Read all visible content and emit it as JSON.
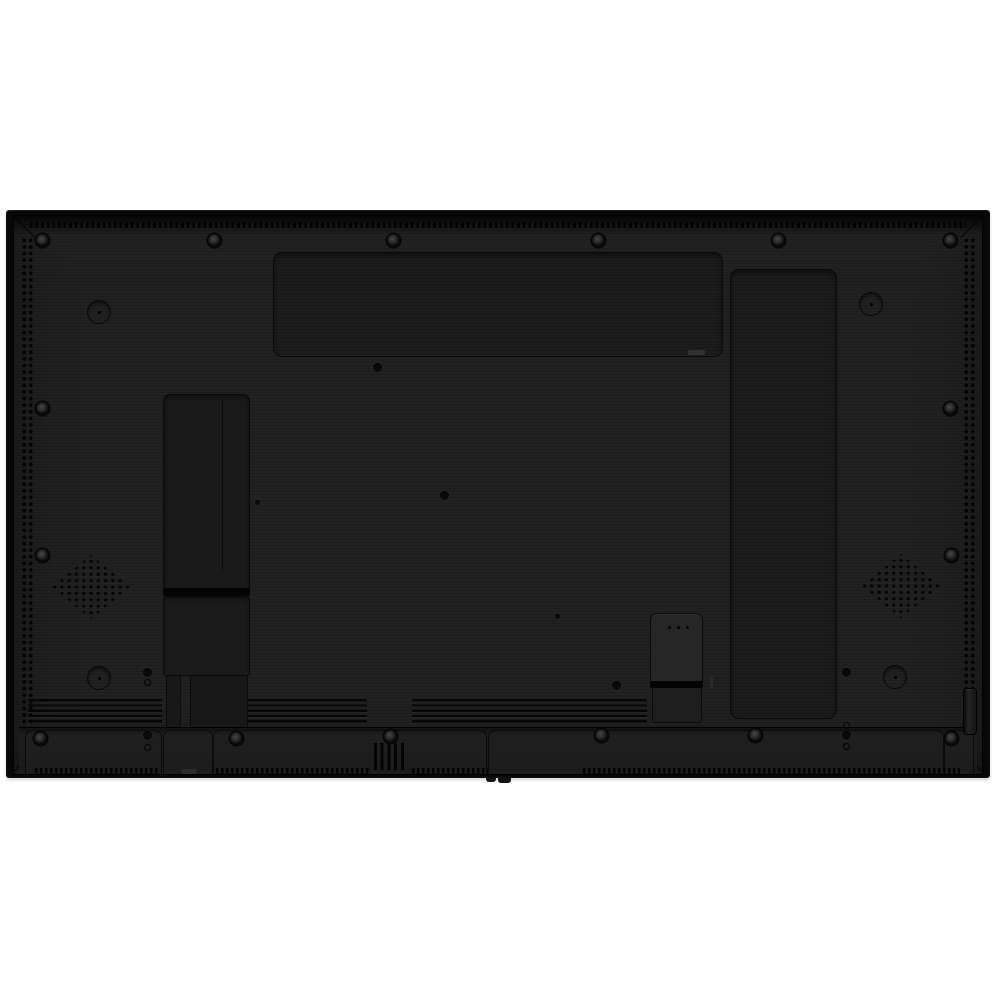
{
  "subject": "rear-of-flat-panel-display",
  "scene": {
    "width": 1000,
    "height": 1000
  },
  "colors": {
    "bg": "#ffffff",
    "shell": "#070707",
    "cover": "#1d1d1d",
    "recess": "#1a1a1a",
    "groove": "#040404",
    "screw-ring": "#474747",
    "vent-dot": "#030303"
  },
  "elements": [
    {
      "name": "tv-outer-shell",
      "cls": "tv-frame",
      "rect": [
        6,
        210,
        984,
        568
      ]
    },
    {
      "name": "tv-back-cover",
      "cls": "tv-back",
      "rect": [
        13,
        215,
        970,
        560
      ]
    },
    {
      "name": "top-edge-shade",
      "cls": "top-shade",
      "rect": [
        13,
        215,
        970,
        20
      ]
    },
    {
      "name": "top-vent-strip",
      "cls": "perf-top",
      "rect": [
        30,
        222,
        936,
        6
      ]
    },
    {
      "name": "left-edge-vent",
      "cls": "vent-col",
      "rect": [
        20,
        236,
        13,
        528
      ]
    },
    {
      "name": "right-edge-vent",
      "cls": "vent-col",
      "rect": [
        962,
        236,
        13,
        528
      ]
    },
    {
      "name": "chamfer-top-left",
      "cls": "chamfer",
      "rect": [
        10,
        227,
        30,
        1
      ],
      "style": {
        "transform": "rotate(45deg)"
      }
    },
    {
      "name": "chamfer-top-right",
      "cls": "chamfer",
      "rect": [
        956,
        227,
        30,
        1
      ],
      "style": {
        "transform": "rotate(-45deg)"
      }
    },
    {
      "name": "chamfer-bottom-left",
      "cls": "chamfer",
      "rect": [
        10,
        760,
        30,
        1
      ],
      "style": {
        "transform": "rotate(-45deg)"
      }
    },
    {
      "name": "chamfer-bottom-right",
      "cls": "chamfer",
      "rect": [
        956,
        760,
        30,
        1
      ],
      "style": {
        "transform": "rotate(45deg)"
      }
    },
    {
      "name": "top-module-bay",
      "cls": "bay",
      "rect": [
        273,
        252,
        450,
        105
      ]
    },
    {
      "name": "module-bay-slot",
      "cls": "slot",
      "rect": [
        688,
        350,
        17,
        5
      ]
    },
    {
      "name": "right-module-bay",
      "cls": "bay",
      "rect": [
        730,
        269,
        107,
        450
      ]
    },
    {
      "name": "cable-channel-upper",
      "cls": "channel",
      "rect": [
        163,
        394,
        87,
        196
      ]
    },
    {
      "name": "channel-inner-line",
      "cls": "hairline-v",
      "rect": [
        222,
        400,
        1,
        170
      ]
    },
    {
      "name": "channel-groove",
      "cls": "groove",
      "rect": [
        163,
        588,
        87,
        8
      ]
    },
    {
      "name": "cable-channel-lower",
      "cls": "channel2",
      "rect": [
        163,
        596,
        87,
        80
      ]
    },
    {
      "name": "channel-leg-left",
      "cls": "leg",
      "rect": [
        166,
        676,
        15,
        52
      ]
    },
    {
      "name": "channel-leg-right",
      "cls": "leg",
      "rect": [
        190,
        676,
        58,
        52
      ]
    },
    {
      "name": "speaker-grille-left",
      "cls": "grille",
      "rect": [
        52,
        555,
        78,
        64
      ]
    },
    {
      "name": "speaker-grille-right",
      "cls": "grille",
      "rect": [
        862,
        554,
        78,
        64
      ]
    },
    {
      "name": "vent-slats-left",
      "cls": "slats",
      "rect": [
        28,
        699,
        134,
        26
      ]
    },
    {
      "name": "vent-slats-middle",
      "cls": "slats",
      "rect": [
        248,
        699,
        119,
        26
      ]
    },
    {
      "name": "vent-slats-right",
      "cls": "slats",
      "rect": [
        412,
        699,
        235,
        26
      ]
    },
    {
      "name": "bottom-band",
      "cls": "band",
      "rect": [
        19,
        727,
        958,
        47
      ]
    },
    {
      "name": "band-section-a",
      "cls": "band-section",
      "rect": [
        25,
        730,
        137,
        44
      ]
    },
    {
      "name": "band-section-b",
      "cls": "band-section",
      "rect": [
        163,
        730,
        50,
        44
      ]
    },
    {
      "name": "band-section-c",
      "cls": "band-section",
      "rect": [
        213,
        730,
        274,
        44
      ]
    },
    {
      "name": "band-section-d",
      "cls": "band-section",
      "rect": [
        488,
        730,
        456,
        44
      ]
    },
    {
      "name": "band-section-e",
      "cls": "band-section",
      "rect": [
        944,
        730,
        30,
        44
      ]
    },
    {
      "name": "bottom-vertical-slots",
      "cls": "vslots",
      "rect": [
        374,
        743,
        33,
        27
      ]
    },
    {
      "name": "service-tab",
      "cls": "tab",
      "rect": [
        181,
        769,
        16,
        5
      ]
    },
    {
      "name": "bottom-perf-1",
      "cls": "perf",
      "rect": [
        35,
        768,
        125,
        6
      ]
    },
    {
      "name": "bottom-perf-2",
      "cls": "perf",
      "rect": [
        216,
        768,
        155,
        6
      ]
    },
    {
      "name": "bottom-perf-3",
      "cls": "perf",
      "rect": [
        412,
        768,
        76,
        6
      ]
    },
    {
      "name": "bottom-perf-4",
      "cls": "perf",
      "rect": [
        583,
        768,
        377,
        6
      ]
    },
    {
      "name": "connector-bay-upper",
      "cls": "cbox-upper",
      "rect": [
        650,
        613,
        53,
        69
      ]
    },
    {
      "name": "connector-groove",
      "cls": "groove",
      "rect": [
        650,
        681,
        53,
        7
      ]
    },
    {
      "name": "connector-bay-lower",
      "cls": "cbox-lower",
      "rect": [
        652,
        688,
        50,
        35
      ]
    },
    {
      "name": "connector-dot-1",
      "cls": "mini-dot",
      "rect": [
        668,
        626,
        3,
        3
      ]
    },
    {
      "name": "connector-dot-2",
      "cls": "mini-dot",
      "rect": [
        677,
        626,
        3,
        3
      ]
    },
    {
      "name": "connector-dot-3",
      "cls": "mini-dot",
      "rect": [
        686,
        626,
        3,
        3
      ]
    },
    {
      "name": "side-slot",
      "cls": "slot-v",
      "rect": [
        710,
        676,
        3,
        13
      ]
    },
    {
      "name": "handle-recess",
      "cls": "handle",
      "rect": [
        963,
        688,
        14,
        47
      ]
    },
    {
      "name": "recess-circle-top-left",
      "cls": "recess-circle",
      "rect": [
        87,
        300,
        24,
        24
      ]
    },
    {
      "name": "recess-circle-top-right",
      "cls": "recess-circle",
      "rect": [
        859,
        292,
        24,
        24
      ]
    },
    {
      "name": "recess-circle-bottom-left",
      "cls": "recess-circle",
      "rect": [
        87,
        666,
        24,
        24
      ]
    },
    {
      "name": "recess-circle-bottom-right",
      "cls": "recess-circle",
      "rect": [
        883,
        665,
        24,
        24
      ]
    },
    {
      "name": "screw",
      "cls": "screw",
      "rect": [
        36,
        234,
        13,
        13
      ]
    },
    {
      "name": "screw",
      "cls": "screw",
      "rect": [
        208,
        234,
        13,
        13
      ]
    },
    {
      "name": "screw",
      "cls": "screw",
      "rect": [
        387,
        234,
        13,
        13
      ]
    },
    {
      "name": "screw",
      "cls": "screw",
      "rect": [
        592,
        234,
        13,
        13
      ]
    },
    {
      "name": "screw",
      "cls": "screw",
      "rect": [
        772,
        234,
        13,
        13
      ]
    },
    {
      "name": "screw",
      "cls": "screw",
      "rect": [
        944,
        234,
        13,
        13
      ]
    },
    {
      "name": "screw",
      "cls": "screw",
      "rect": [
        36,
        402,
        13,
        13
      ]
    },
    {
      "name": "screw",
      "cls": "screw",
      "rect": [
        944,
        402,
        13,
        13
      ]
    },
    {
      "name": "screw",
      "cls": "screw",
      "rect": [
        36,
        549,
        13,
        13
      ]
    },
    {
      "name": "screw",
      "cls": "screw",
      "rect": [
        945,
        549,
        13,
        13
      ]
    },
    {
      "name": "screw",
      "cls": "screw",
      "rect": [
        34,
        732,
        13,
        13
      ]
    },
    {
      "name": "screw",
      "cls": "screw",
      "rect": [
        230,
        732,
        13,
        13
      ]
    },
    {
      "name": "screw",
      "cls": "screw",
      "rect": [
        384,
        730,
        13,
        13
      ]
    },
    {
      "name": "screw",
      "cls": "screw",
      "rect": [
        595,
        729,
        13,
        13
      ]
    },
    {
      "name": "screw",
      "cls": "screw",
      "rect": [
        749,
        729,
        13,
        13
      ]
    },
    {
      "name": "screw",
      "cls": "screw",
      "rect": [
        945,
        732,
        13,
        13
      ]
    },
    {
      "name": "screw-hole",
      "cls": "pin",
      "rect": [
        373,
        363,
        9,
        9
      ]
    },
    {
      "name": "screw-hole",
      "cls": "pin",
      "rect": [
        440,
        491,
        9,
        9
      ]
    },
    {
      "name": "screw-hole",
      "cls": "pin",
      "rect": [
        143,
        668,
        9,
        9
      ]
    },
    {
      "name": "screw-hole",
      "cls": "pin",
      "rect": [
        612,
        681,
        9,
        9
      ]
    },
    {
      "name": "screw-hole",
      "cls": "pin",
      "rect": [
        842,
        668,
        9,
        9
      ]
    },
    {
      "name": "screw-hole",
      "cls": "pin",
      "rect": [
        143,
        731,
        9,
        9
      ]
    },
    {
      "name": "screw-hole",
      "cls": "pin",
      "rect": [
        842,
        731,
        9,
        9
      ]
    },
    {
      "name": "pin-hole",
      "cls": "pin",
      "rect": [
        555,
        614,
        5,
        5
      ]
    },
    {
      "name": "pin-hole",
      "cls": "pin",
      "rect": [
        255,
        500,
        5,
        5
      ]
    },
    {
      "name": "alignment-hole",
      "cls": "ringlet",
      "rect": [
        144,
        679,
        7,
        7
      ]
    },
    {
      "name": "alignment-hole",
      "cls": "ringlet",
      "rect": [
        144,
        744,
        7,
        7
      ]
    },
    {
      "name": "alignment-hole",
      "cls": "ringlet",
      "rect": [
        843,
        722,
        7,
        7
      ]
    },
    {
      "name": "alignment-hole",
      "cls": "ringlet",
      "rect": [
        843,
        743,
        7,
        7
      ]
    },
    {
      "name": "bottom-foot",
      "cls": "foot",
      "rect": [
        486,
        777,
        10,
        5
      ]
    },
    {
      "name": "bottom-foot",
      "cls": "foot",
      "rect": [
        498,
        777,
        13,
        6
      ]
    }
  ]
}
